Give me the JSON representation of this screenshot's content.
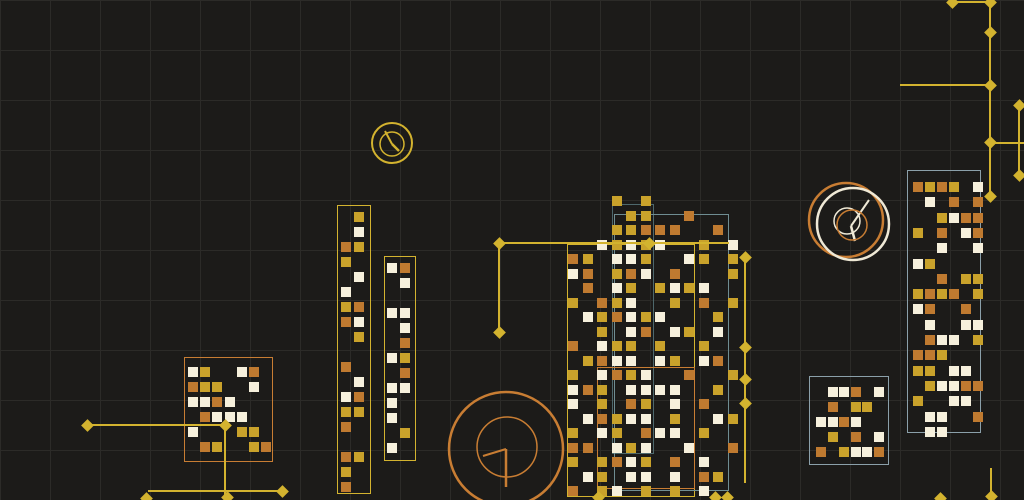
{
  "canvas": {
    "width": 1024,
    "height": 500,
    "background": "#1c1b19",
    "grid_color": "#2c2b28",
    "grid_size": 50
  },
  "palette": {
    "gold": "#c9a22b",
    "orange": "#bf7a30",
    "white": "#f6f0dc",
    "line_yellow": "#d3b32f",
    "line_orange": "#c87d33",
    "line_white": "#efe9d6",
    "teal": "#6f8d92",
    "teal_dark": "#4e686c",
    "steel": "#8ba0aa"
  },
  "frames": [
    {
      "x": 184,
      "y": 357,
      "w": 89,
      "h": 105,
      "color": "line_orange"
    },
    {
      "x": 337,
      "y": 205,
      "w": 34,
      "h": 289,
      "color": "line_yellow"
    },
    {
      "x": 384,
      "y": 256,
      "w": 32,
      "h": 205,
      "color": "line_yellow"
    },
    {
      "x": 567,
      "y": 244,
      "w": 128,
      "h": 253,
      "color": "line_yellow"
    },
    {
      "x": 612,
      "y": 204,
      "w": 42,
      "h": 250,
      "color": "teal_dark"
    },
    {
      "x": 614,
      "y": 214,
      "w": 115,
      "h": 277,
      "color": "teal"
    },
    {
      "x": 597,
      "y": 367,
      "w": 98,
      "h": 122,
      "color": "line_orange"
    },
    {
      "x": 907,
      "y": 170,
      "w": 74,
      "h": 263,
      "color": "steel"
    },
    {
      "x": 809,
      "y": 376,
      "w": 80,
      "h": 89,
      "color": "steel"
    }
  ],
  "clusters": [
    {
      "name": "left-block-cluster",
      "x0": 188,
      "y0": 367,
      "px": 12.2,
      "py": 15,
      "rows": [
        "WG..WO.",
        "OGG..W.",
        "WWOW...",
        ".OWWW..",
        "W...GG.",
        ".OG..GO"
      ]
    },
    {
      "name": "tall-column-1",
      "x0": 341,
      "y0": 212,
      "px": 13,
      "py": 15,
      "rows": [
        ".G",
        ".W",
        "OG",
        "G.",
        ".W",
        "W.",
        "GO",
        "OW",
        ".G",
        "..",
        "O.",
        ".W",
        "WO",
        "GG",
        "O.",
        "..",
        "OG",
        "G.",
        "O."
      ]
    },
    {
      "name": "tall-column-2",
      "x0": 387,
      "y0": 263,
      "px": 13,
      "py": 15,
      "rows": [
        "WO",
        ".W",
        "..",
        "WW",
        ".W",
        ".O",
        "WG",
        ".O",
        "WW",
        "W.",
        "W.",
        ".G",
        "W."
      ]
    },
    {
      "name": "central-dense-cluster",
      "x0": 568,
      "y0": 196,
      "px": 14.5,
      "py": 14.5,
      "rows": [
        "...G.G......",
        "....GG..O...",
        "...GGOOO..O.",
        "..WGWGW..G.W",
        "OG.WWG..WG.G",
        "WO.GOW.O...G",
        ".O.WG.GWGW..",
        "G.OGW..G.O.G",
        ".WGOWGW...G.",
        "..G.WO.WG.W.",
        "O.WGG.G..G..",
        ".GOWW.WG.WO.",
        "G.WOGW..O..G",
        "WOG.WWWW..G.",
        "W.G.OG.W.O..",
        ".WOGWW.G..WG",
        "G.WG.OWW.G..",
        "OO.WGW..W..O",
        "G.GOWG.O.W..",
        ".WG.WW.W.OG.",
        "O.GW.G.G.W.."
      ]
    },
    {
      "name": "right-tall-cluster",
      "x0": 913,
      "y0": 182,
      "px": 12,
      "py": 15.3,
      "rows": [
        "OGOG.W",
        ".W.O.O",
        "..GWOO",
        "G.O.WO",
        "..W..W",
        "WG....",
        "..O.GG",
        "GOGO.G",
        "WO..O.",
        ".W..WW",
        ".OWW.G",
        "OOG...",
        "GG.WW.",
        ".GWWOO",
        "G..WW.",
        ".WW..O",
        ".WW..."
      ]
    },
    {
      "name": "bottom-right-cluster",
      "x0": 816,
      "y0": 387,
      "px": 11.6,
      "py": 15,
      "rows": [
        ".WWO.W",
        ".O.GG.",
        "WWOW..",
        ".G.O.W",
        "O.GWWO"
      ]
    }
  ],
  "circles": [
    {
      "cx": 392,
      "cy": 143,
      "r": 20,
      "color": "line_yellow",
      "w": 2
    },
    {
      "cx": 392,
      "cy": 144,
      "r": 12,
      "color": "line_yellow",
      "w": 1.5
    },
    {
      "cx": 846,
      "cy": 220,
      "r": 37,
      "color": "line_orange",
      "w": 2.5
    },
    {
      "cx": 853,
      "cy": 224,
      "r": 36,
      "color": "line_white",
      "w": 2.5
    },
    {
      "cx": 847,
      "cy": 221,
      "r": 13,
      "color": "line_white",
      "w": 1.5
    },
    {
      "cx": 852,
      "cy": 225,
      "r": 15,
      "color": "line_orange",
      "w": 1.5
    },
    {
      "cx": 506,
      "cy": 449,
      "r": 57,
      "color": "line_orange",
      "w": 2.5
    },
    {
      "cx": 507,
      "cy": 447,
      "r": 30,
      "color": "line_orange",
      "w": 1.5
    }
  ],
  "hands": [
    {
      "x1": 392,
      "y1": 144,
      "x2": 385,
      "y2": 131,
      "color": "line_yellow",
      "w": 2
    },
    {
      "x1": 392,
      "y1": 144,
      "x2": 399,
      "y2": 151,
      "color": "line_yellow",
      "w": 2.5
    },
    {
      "x1": 851,
      "y1": 226,
      "x2": 869,
      "y2": 200,
      "color": "line_white",
      "w": 2
    },
    {
      "x1": 851,
      "y1": 226,
      "x2": 855,
      "y2": 241,
      "color": "line_white",
      "w": 2.5
    },
    {
      "x1": 506,
      "y1": 449,
      "x2": 483,
      "y2": 456,
      "color": "line_orange",
      "w": 2
    },
    {
      "x1": 506,
      "y1": 449,
      "x2": 506,
      "y2": 487,
      "color": "line_orange",
      "w": 2.5
    }
  ],
  "lines": [
    {
      "x1": 87,
      "y1": 425,
      "x2": 225,
      "y2": 425,
      "color": "line_yellow",
      "w": 2
    },
    {
      "x1": 225,
      "y1": 425,
      "x2": 225,
      "y2": 497,
      "color": "line_yellow",
      "w": 2
    },
    {
      "x1": 148,
      "y1": 491,
      "x2": 282,
      "y2": 491,
      "color": "line_yellow",
      "w": 2
    },
    {
      "x1": 146,
      "y1": 498,
      "x2": 146,
      "y2": 500,
      "color": "line_yellow",
      "w": 2
    },
    {
      "x1": 499,
      "y1": 243,
      "x2": 729,
      "y2": 243,
      "color": "line_yellow",
      "w": 2
    },
    {
      "x1": 499,
      "y1": 243,
      "x2": 499,
      "y2": 332,
      "color": "line_yellow",
      "w": 2
    },
    {
      "x1": 745,
      "y1": 257,
      "x2": 745,
      "y2": 483,
      "color": "line_yellow",
      "w": 2
    },
    {
      "x1": 952,
      "y1": 2,
      "x2": 990,
      "y2": 2,
      "color": "line_yellow",
      "w": 2
    },
    {
      "x1": 990,
      "y1": 2,
      "x2": 990,
      "y2": 196,
      "color": "line_yellow",
      "w": 2
    },
    {
      "x1": 900,
      "y1": 85,
      "x2": 990,
      "y2": 85,
      "color": "line_yellow",
      "w": 2
    },
    {
      "x1": 990,
      "y1": 143,
      "x2": 1024,
      "y2": 143,
      "color": "line_yellow",
      "w": 2
    },
    {
      "x1": 1019,
      "y1": 105,
      "x2": 1019,
      "y2": 175,
      "color": "line_yellow",
      "w": 2
    },
    {
      "x1": 991,
      "y1": 468,
      "x2": 991,
      "y2": 496,
      "color": "line_yellow",
      "w": 2
    }
  ],
  "nodes": [
    {
      "x": 87,
      "y": 425
    },
    {
      "x": 225,
      "y": 425
    },
    {
      "x": 227,
      "y": 497
    },
    {
      "x": 282,
      "y": 491
    },
    {
      "x": 146,
      "y": 498
    },
    {
      "x": 499,
      "y": 243
    },
    {
      "x": 499,
      "y": 332
    },
    {
      "x": 649,
      "y": 243
    },
    {
      "x": 745,
      "y": 257
    },
    {
      "x": 745,
      "y": 347
    },
    {
      "x": 745,
      "y": 379
    },
    {
      "x": 745,
      "y": 403
    },
    {
      "x": 952,
      "y": 2
    },
    {
      "x": 990,
      "y": 2
    },
    {
      "x": 990,
      "y": 32
    },
    {
      "x": 990,
      "y": 85
    },
    {
      "x": 990,
      "y": 142
    },
    {
      "x": 990,
      "y": 196
    },
    {
      "x": 1019,
      "y": 105
    },
    {
      "x": 1019,
      "y": 175
    },
    {
      "x": 991,
      "y": 496
    },
    {
      "x": 940,
      "y": 498
    },
    {
      "x": 598,
      "y": 497
    },
    {
      "x": 715,
      "y": 497
    },
    {
      "x": 727,
      "y": 497
    }
  ],
  "node_color": "line_yellow"
}
